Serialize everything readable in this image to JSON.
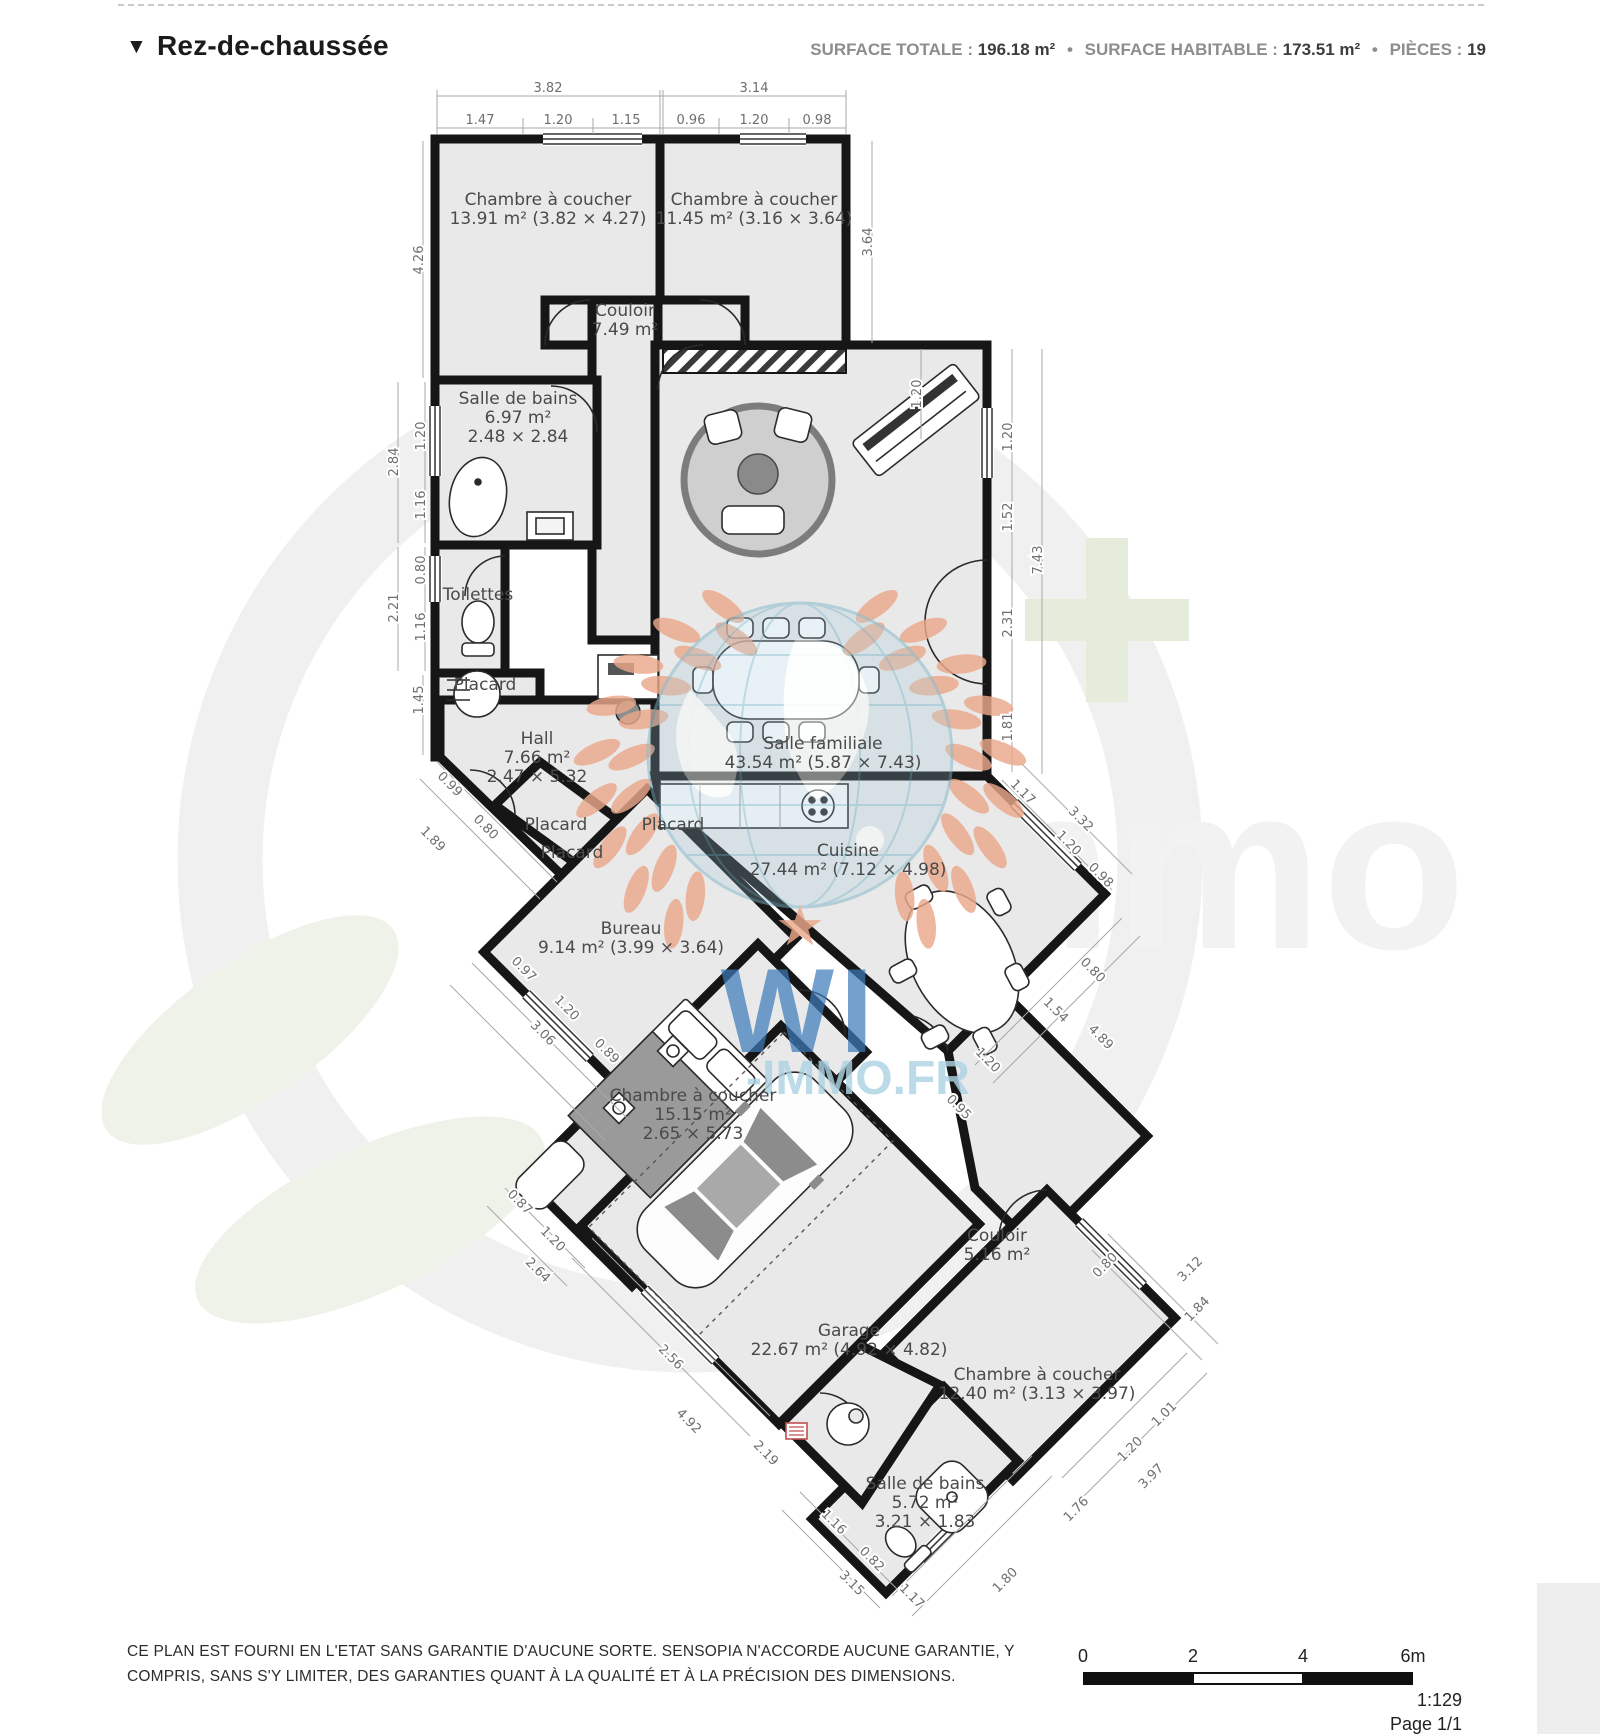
{
  "header": {
    "marker": "▼",
    "title": "Rez-de-chaussée",
    "separator": "•",
    "stats": [
      {
        "label": "SURFACE TOTALE :",
        "value": "196.18 m²"
      },
      {
        "label": "SURFACE HABITABLE :",
        "value": "173.51 m²"
      },
      {
        "label": "PIÈCES :",
        "value": "19"
      }
    ]
  },
  "plan": {
    "rooms": [
      {
        "id": "chambre-1",
        "lines": [
          "Chambre à coucher",
          "13.91 m² (3.82 × 4.27)"
        ],
        "x": 548,
        "y": 205
      },
      {
        "id": "chambre-2",
        "lines": [
          "Chambre à coucher",
          "11.45 m² (3.16 × 3.64)"
        ],
        "x": 754,
        "y": 205
      },
      {
        "id": "couloir-1",
        "lines": [
          "Couloir",
          "7.49 m²"
        ],
        "x": 625,
        "y": 316
      },
      {
        "id": "salle-de-bains-1",
        "lines": [
          "Salle de bains",
          "6.97 m²",
          "2.48 × 2.84"
        ],
        "x": 518,
        "y": 404
      },
      {
        "id": "toilettes",
        "lines": [
          "Toilettes"
        ],
        "x": 478,
        "y": 600
      },
      {
        "id": "placard-1",
        "lines": [
          "Placard"
        ],
        "x": 485,
        "y": 690
      },
      {
        "id": "hall",
        "lines": [
          "Hall",
          "7.66 m²",
          "2.47 × 5.32"
        ],
        "x": 537,
        "y": 744
      },
      {
        "id": "salle-familiale",
        "lines": [
          "Salle familiale",
          "43.54 m² (5.87 × 7.43)"
        ],
        "x": 823,
        "y": 749
      },
      {
        "id": "placard-2",
        "lines": [
          "Placard"
        ],
        "x": 556,
        "y": 830
      },
      {
        "id": "placard-3",
        "lines": [
          "Placard"
        ],
        "x": 572,
        "y": 858
      },
      {
        "id": "placard-4",
        "lines": [
          "Placard"
        ],
        "x": 673,
        "y": 830
      },
      {
        "id": "cuisine",
        "lines": [
          "Cuisine",
          "27.44 m² (7.12 × 4.98)"
        ],
        "x": 848,
        "y": 856
      },
      {
        "id": "bureau",
        "lines": [
          "Bureau",
          "9.14 m² (3.99 × 3.64)"
        ],
        "x": 631,
        "y": 934
      },
      {
        "id": "chambre-3",
        "lines": [
          "Chambre à coucher",
          "15.15 m²",
          "2.65 × 5.73"
        ],
        "x": 693,
        "y": 1101
      },
      {
        "id": "couloir-2",
        "lines": [
          "Couloir",
          "5.16 m²"
        ],
        "x": 997,
        "y": 1241
      },
      {
        "id": "garage",
        "lines": [
          "Garage",
          "22.67 m² (4.92 × 4.82)"
        ],
        "x": 849,
        "y": 1336
      },
      {
        "id": "chambre-4",
        "lines": [
          "Chambre à coucher",
          "12.40 m² (3.13 × 3.97)"
        ],
        "x": 1037,
        "y": 1380
      },
      {
        "id": "salle-de-bains-2",
        "lines": [
          "Salle de bains",
          "5.72 m²",
          "3.21 × 1.83"
        ],
        "x": 925,
        "y": 1489
      }
    ],
    "dimensions": [
      {
        "v": "3.82",
        "x": 548,
        "y": 92,
        "r": 0
      },
      {
        "v": "1.47",
        "x": 480,
        "y": 124,
        "r": 0
      },
      {
        "v": "1.20",
        "x": 558,
        "y": 124,
        "r": 0
      },
      {
        "v": "1.15",
        "x": 626,
        "y": 124,
        "r": 0
      },
      {
        "v": "3.14",
        "x": 754,
        "y": 92,
        "r": 0
      },
      {
        "v": "0.96",
        "x": 691,
        "y": 124,
        "r": 0
      },
      {
        "v": "1.20",
        "x": 754,
        "y": 124,
        "r": 0
      },
      {
        "v": "0.98",
        "x": 817,
        "y": 124,
        "r": 0
      },
      {
        "v": "4.26",
        "x": 423,
        "y": 260,
        "r": -90
      },
      {
        "v": "3.64",
        "x": 872,
        "y": 242,
        "r": -90
      },
      {
        "v": "2.84",
        "x": 398,
        "y": 462,
        "r": -90
      },
      {
        "v": "1.20",
        "x": 425,
        "y": 436,
        "r": -90
      },
      {
        "v": "1.16",
        "x": 425,
        "y": 505,
        "r": -90
      },
      {
        "v": "2.21",
        "x": 398,
        "y": 608,
        "r": -90
      },
      {
        "v": "0.80",
        "x": 425,
        "y": 570,
        "r": -90
      },
      {
        "v": "1.16",
        "x": 425,
        "y": 627,
        "r": -90
      },
      {
        "v": "1.45",
        "x": 423,
        "y": 700,
        "r": -90
      },
      {
        "v": "1.20",
        "x": 921,
        "y": 394,
        "r": -90
      },
      {
        "v": "1.20",
        "x": 1012,
        "y": 437,
        "r": -90
      },
      {
        "v": "1.52",
        "x": 1012,
        "y": 517,
        "r": -90
      },
      {
        "v": "2.31",
        "x": 1012,
        "y": 623,
        "r": -90
      },
      {
        "v": "1.81",
        "x": 1012,
        "y": 727,
        "r": -90
      },
      {
        "v": "7.43",
        "x": 1042,
        "y": 560,
        "r": -90
      },
      {
        "v": "0.99",
        "x": 447,
        "y": 787,
        "r": 45
      },
      {
        "v": "0.80",
        "x": 483,
        "y": 830,
        "r": 45
      },
      {
        "v": "1.89",
        "x": 430,
        "y": 842,
        "r": 45
      },
      {
        "v": "1.17",
        "x": 1020,
        "y": 795,
        "r": 45
      },
      {
        "v": "3.32",
        "x": 1078,
        "y": 822,
        "r": 45
      },
      {
        "v": "1.20",
        "x": 1066,
        "y": 846,
        "r": 45
      },
      {
        "v": "0.98",
        "x": 1098,
        "y": 878,
        "r": 45
      },
      {
        "v": "0.80",
        "x": 1090,
        "y": 973,
        "r": 45
      },
      {
        "v": "1.54",
        "x": 1053,
        "y": 1013,
        "r": 45
      },
      {
        "v": "4.89",
        "x": 1098,
        "y": 1040,
        "r": 45
      },
      {
        "v": "1.20",
        "x": 985,
        "y": 1063,
        "r": 45
      },
      {
        "v": "0.95",
        "x": 956,
        "y": 1110,
        "r": 45
      },
      {
        "v": "0.97",
        "x": 521,
        "y": 972,
        "r": 45
      },
      {
        "v": "1.20",
        "x": 564,
        "y": 1011,
        "r": 45
      },
      {
        "v": "0.89",
        "x": 604,
        "y": 1054,
        "r": 45
      },
      {
        "v": "3.06",
        "x": 540,
        "y": 1036,
        "r": 45
      },
      {
        "v": "0.87",
        "x": 517,
        "y": 1205,
        "r": 45
      },
      {
        "v": "1.20",
        "x": 550,
        "y": 1242,
        "r": 45
      },
      {
        "v": "2.64",
        "x": 535,
        "y": 1273,
        "r": 45
      },
      {
        "v": "2.56",
        "x": 668,
        "y": 1360,
        "r": 45
      },
      {
        "v": "4.92",
        "x": 686,
        "y": 1424,
        "r": 45
      },
      {
        "v": "2.19",
        "x": 763,
        "y": 1456,
        "r": 45
      },
      {
        "v": "1.16",
        "x": 831,
        "y": 1525,
        "r": 45
      },
      {
        "v": "0.82",
        "x": 869,
        "y": 1562,
        "r": 45
      },
      {
        "v": "3.15",
        "x": 849,
        "y": 1586,
        "r": 45
      },
      {
        "v": "1.17",
        "x": 909,
        "y": 1599,
        "r": 45
      },
      {
        "v": "1.80",
        "x": 1008,
        "y": 1583,
        "r": -45
      },
      {
        "v": "1.76",
        "x": 1079,
        "y": 1512,
        "r": -45
      },
      {
        "v": "1.01",
        "x": 1167,
        "y": 1417,
        "r": -45
      },
      {
        "v": "1.20",
        "x": 1133,
        "y": 1452,
        "r": -45
      },
      {
        "v": "3.97",
        "x": 1154,
        "y": 1479,
        "r": -45
      },
      {
        "v": "0.80",
        "x": 1108,
        "y": 1268,
        "r": -45
      },
      {
        "v": "3.12",
        "x": 1193,
        "y": 1272,
        "r": -45
      },
      {
        "v": "1.84",
        "x": 1200,
        "y": 1312,
        "r": -45
      }
    ]
  },
  "watermark": {
    "brand_main": "WI",
    "brand_sub": "-IMMO.FR",
    "bg_letters": "mmo",
    "bg_plus": "+",
    "star": "★",
    "accent_salmon": "#eba98b",
    "accent_blue": "#3e7cba",
    "accent_lightblue": "#aed3e4"
  },
  "footer": {
    "disclaimer": [
      "CE PLAN EST FOURNI EN L'ETAT SANS GARANTIE D'AUCUNE SORTE. SENSOPIA N'ACCORDE AUCUNE GARANTIE, Y",
      "COMPRIS, SANS S'Y LIMITER, DES GARANTIES QUANT À LA QUALITÉ ET À LA PRÉCISION DES DIMENSIONS."
    ],
    "scale": {
      "ticks": [
        "0",
        "2",
        "4",
        "6m"
      ],
      "ratio": "1:129",
      "page": "Page 1/1"
    }
  }
}
